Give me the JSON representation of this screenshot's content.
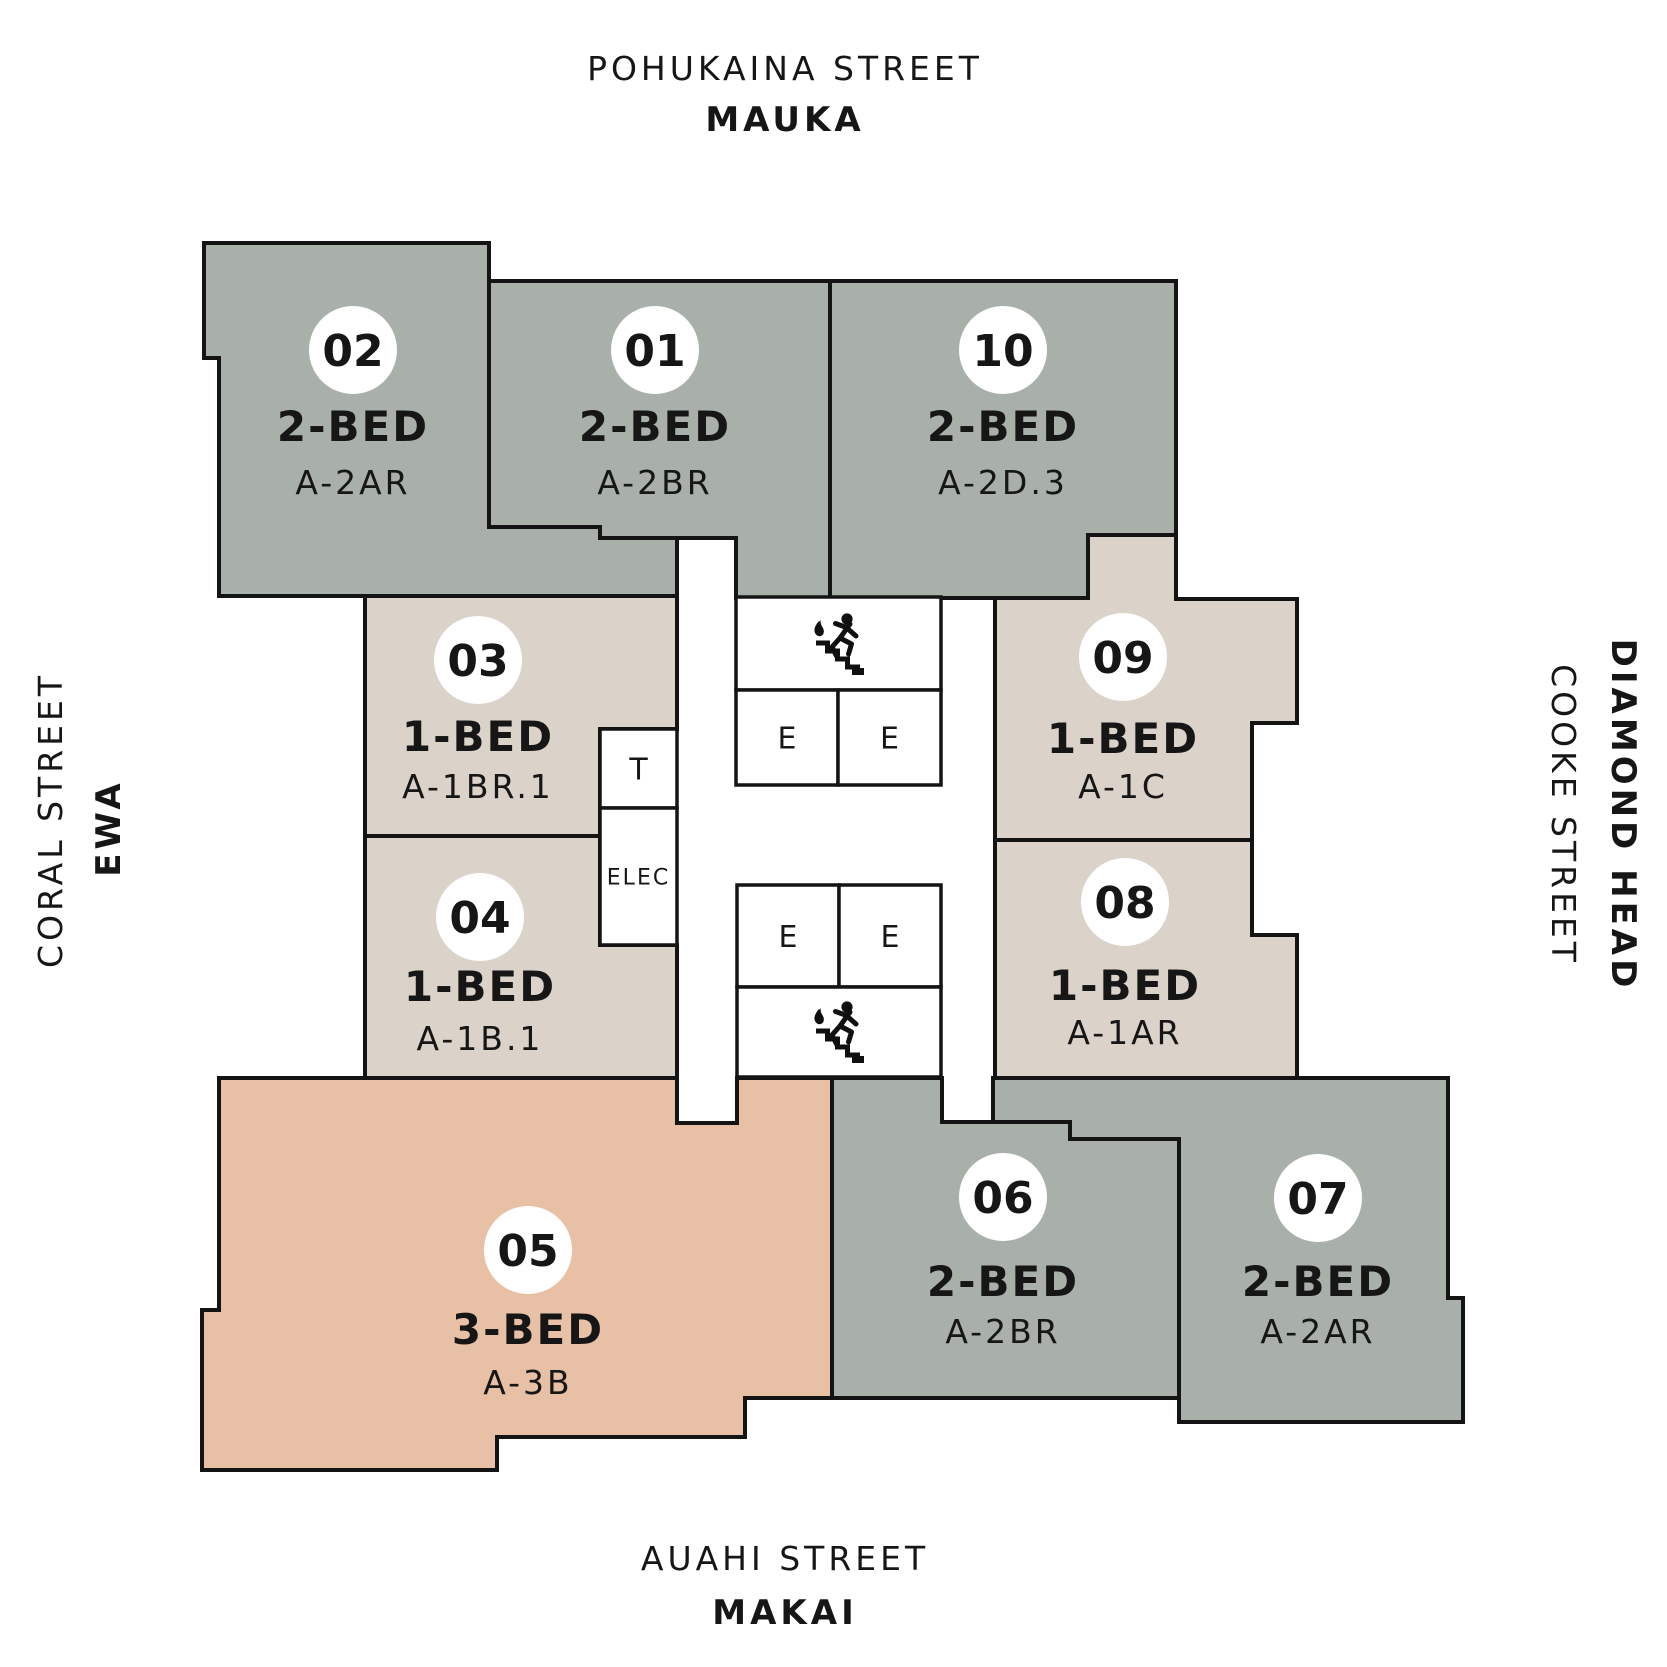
{
  "palette": {
    "gray": "#a9b0aa",
    "beige": "#dbd2c9",
    "salmon": "#e8c0a5",
    "room_fill": "#ffffff",
    "line": "#141414",
    "circle_fill": "#ffffff",
    "text": "#161616"
  },
  "streets": {
    "top": {
      "name": "POHUKAINA STREET",
      "direction": "MAUKA"
    },
    "left": {
      "name": "CORAL STREET",
      "direction": "EWA"
    },
    "right": {
      "name": "COOKE STREET",
      "direction": "DIAMOND HEAD"
    },
    "bottom": {
      "name": "AUAHI STREET",
      "direction": "MAKAI"
    }
  },
  "units": [
    {
      "id": "02",
      "number": "02",
      "bed": "2-BED",
      "type": "A-2AR",
      "color": "gray",
      "polygon": [
        [
          204,
          243
        ],
        [
          489,
          243
        ],
        [
          489,
          527
        ],
        [
          600,
          527
        ],
        [
          600,
          538
        ],
        [
          677,
          538
        ],
        [
          677,
          596
        ],
        [
          219,
          596
        ],
        [
          219,
          358
        ],
        [
          204,
          358
        ]
      ],
      "label": {
        "cx": 353,
        "circle_cy": 350,
        "bed_y": 441,
        "code_y": 494
      }
    },
    {
      "id": "01",
      "number": "01",
      "bed": "2-BED",
      "type": "A-2BR",
      "color": "gray",
      "polygon": [
        [
          489,
          281
        ],
        [
          830,
          281
        ],
        [
          830,
          598
        ],
        [
          736,
          598
        ],
        [
          736,
          538
        ],
        [
          600,
          538
        ],
        [
          600,
          527
        ],
        [
          489,
          527
        ]
      ],
      "label": {
        "cx": 655,
        "circle_cy": 350,
        "bed_y": 441,
        "code_y": 494
      }
    },
    {
      "id": "10",
      "number": "10",
      "bed": "2-BED",
      "type": "A-2D.3",
      "color": "gray",
      "polygon": [
        [
          830,
          281
        ],
        [
          1176,
          281
        ],
        [
          1176,
          535
        ],
        [
          1088,
          535
        ],
        [
          1088,
          598
        ],
        [
          830,
          598
        ]
      ],
      "label": {
        "cx": 1003,
        "circle_cy": 350,
        "bed_y": 441,
        "code_y": 494
      }
    },
    {
      "id": "03",
      "number": "03",
      "bed": "1-BED",
      "type": "A-1BR.1",
      "color": "beige",
      "polygon": [
        [
          365,
          596
        ],
        [
          677,
          596
        ],
        [
          677,
          729
        ],
        [
          600,
          729
        ],
        [
          600,
          836
        ],
        [
          365,
          836
        ]
      ],
      "label": {
        "cx": 478,
        "circle_cy": 660,
        "bed_y": 751,
        "code_y": 798
      }
    },
    {
      "id": "09",
      "number": "09",
      "bed": "1-BED",
      "type": "A-1C",
      "color": "beige",
      "polygon": [
        [
          995,
          598
        ],
        [
          1088,
          598
        ],
        [
          1088,
          535
        ],
        [
          1176,
          535
        ],
        [
          1176,
          599
        ],
        [
          1297,
          599
        ],
        [
          1297,
          723
        ],
        [
          1252,
          723
        ],
        [
          1252,
          840
        ],
        [
          995,
          840
        ]
      ],
      "label": {
        "cx": 1123,
        "circle_cy": 657,
        "bed_y": 753,
        "code_y": 798
      }
    },
    {
      "id": "04",
      "number": "04",
      "bed": "1-BED",
      "type": "A-1B.1",
      "color": "beige",
      "polygon": [
        [
          365,
          836
        ],
        [
          600,
          836
        ],
        [
          600,
          945
        ],
        [
          677,
          945
        ],
        [
          677,
          1078
        ],
        [
          365,
          1078
        ]
      ],
      "label": {
        "cx": 480,
        "circle_cy": 917,
        "bed_y": 1001,
        "code_y": 1050
      }
    },
    {
      "id": "08",
      "number": "08",
      "bed": "1-BED",
      "type": "A-1AR",
      "color": "beige",
      "polygon": [
        [
          995,
          840
        ],
        [
          1252,
          840
        ],
        [
          1252,
          935
        ],
        [
          1297,
          935
        ],
        [
          1297,
          1078
        ],
        [
          995,
          1078
        ]
      ],
      "label": {
        "cx": 1125,
        "circle_cy": 902,
        "bed_y": 1000,
        "code_y": 1044
      }
    },
    {
      "id": "05",
      "number": "05",
      "bed": "3-BED",
      "type": "A-3B",
      "color": "salmon",
      "polygon": [
        [
          219,
          1078
        ],
        [
          677,
          1078
        ],
        [
          677,
          1123
        ],
        [
          737,
          1123
        ],
        [
          737,
          1078
        ],
        [
          832,
          1078
        ],
        [
          832,
          1398
        ],
        [
          745,
          1398
        ],
        [
          745,
          1437
        ],
        [
          497,
          1437
        ],
        [
          497,
          1470
        ],
        [
          202,
          1470
        ],
        [
          202,
          1310
        ],
        [
          219,
          1310
        ]
      ],
      "label": {
        "cx": 528,
        "circle_cy": 1250,
        "bed_y": 1344,
        "code_y": 1394
      }
    },
    {
      "id": "06",
      "number": "06",
      "bed": "2-BED",
      "type": "A-2BR",
      "color": "gray",
      "polygon": [
        [
          832,
          1078
        ],
        [
          942,
          1078
        ],
        [
          942,
          1122
        ],
        [
          1070,
          1122
        ],
        [
          1070,
          1139
        ],
        [
          1179,
          1139
        ],
        [
          1179,
          1398
        ],
        [
          832,
          1398
        ]
      ],
      "label": {
        "cx": 1003,
        "circle_cy": 1197,
        "bed_y": 1296,
        "code_y": 1343
      }
    },
    {
      "id": "07",
      "number": "07",
      "bed": "2-BED",
      "type": "A-2AR",
      "color": "gray",
      "polygon": [
        [
          993,
          1078
        ],
        [
          1448,
          1078
        ],
        [
          1448,
          1298
        ],
        [
          1463,
          1298
        ],
        [
          1463,
          1422
        ],
        [
          1179,
          1422
        ],
        [
          1179,
          1139
        ],
        [
          1070,
          1139
        ],
        [
          1070,
          1122
        ],
        [
          993,
          1122
        ]
      ],
      "label": {
        "cx": 1318,
        "circle_cy": 1198,
        "bed_y": 1296,
        "code_y": 1343
      }
    }
  ],
  "core_rooms": [
    {
      "name": "stair-upper",
      "kind": "stair",
      "label": "",
      "rect": [
        736,
        597,
        205,
        93
      ]
    },
    {
      "name": "elevator-1",
      "kind": "elevator",
      "label": "E",
      "rect": [
        736,
        690,
        102,
        95
      ]
    },
    {
      "name": "elevator-2",
      "kind": "elevator",
      "label": "E",
      "rect": [
        838,
        690,
        103,
        95
      ]
    },
    {
      "name": "trash-room",
      "kind": "trash",
      "label": "T",
      "rect": [
        600,
        729,
        77,
        79
      ]
    },
    {
      "name": "electrical-room",
      "kind": "electrical",
      "label": "ELEC",
      "rect": [
        600,
        808,
        77,
        137
      ]
    },
    {
      "name": "elevator-3",
      "kind": "elevator",
      "label": "E",
      "rect": [
        737,
        885,
        102,
        102
      ]
    },
    {
      "name": "elevator-4",
      "kind": "elevator",
      "label": "E",
      "rect": [
        839,
        885,
        102,
        102
      ]
    },
    {
      "name": "stair-lower",
      "kind": "stair",
      "label": "",
      "rect": [
        737,
        987,
        204,
        90
      ]
    }
  ],
  "icons": [
    {
      "name": "fire-exit-stairs-icon",
      "x": 806,
      "y": 610
    },
    {
      "name": "fire-exit-stairs-icon",
      "x": 806,
      "y": 998
    }
  ]
}
